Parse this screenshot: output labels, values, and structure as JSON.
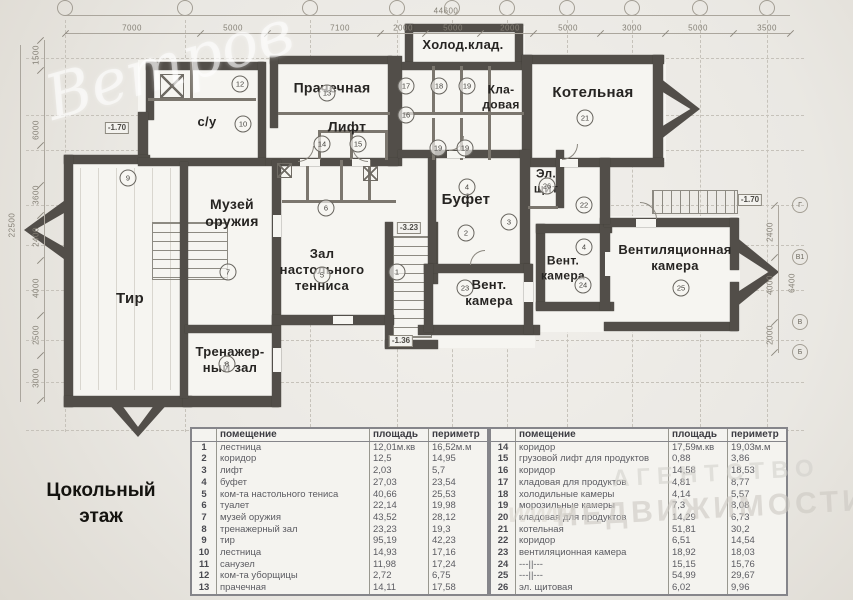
{
  "title": "Цокольный этаж",
  "watermark": {
    "script": "Ветров",
    "line1": "АГЕНТСТВО",
    "line2": "НЕДВИЖИМОСТИ",
    "url": "www"
  },
  "dims": {
    "top_total": {
      "t": "44600",
      "x": 446
    },
    "top": [
      {
        "t": "7000",
        "x": 132
      },
      {
        "t": "5000",
        "x": 233
      },
      {
        "t": "7100",
        "x": 340
      },
      {
        "t": "2000",
        "x": 403
      },
      {
        "t": "5000",
        "x": 453
      },
      {
        "t": "2000",
        "x": 510
      },
      {
        "t": "5000",
        "x": 568
      },
      {
        "t": "3000",
        "x": 632
      },
      {
        "t": "5000",
        "x": 698
      },
      {
        "t": "3500",
        "x": 767
      }
    ],
    "left_total": {
      "t": "22500",
      "y": 225
    },
    "left": [
      {
        "t": "1500",
        "y": 55
      },
      {
        "t": "6000",
        "y": 130
      },
      {
        "t": "3600",
        "y": 195
      },
      {
        "t": "2400",
        "y": 237
      },
      {
        "t": "4000",
        "y": 288
      },
      {
        "t": "2500",
        "y": 335
      },
      {
        "t": "3000",
        "y": 378
      }
    ],
    "right_total": {
      "t": "6400",
      "y": 283
    },
    "right": [
      {
        "t": "2400",
        "y": 232
      },
      {
        "t": "4000",
        "y": 285
      },
      {
        "t": "2000",
        "y": 335
      }
    ]
  },
  "axes": {
    "top_x": [
      65,
      185,
      310,
      397,
      452,
      507,
      567,
      632,
      700,
      767
    ],
    "right": [
      {
        "t": "Г",
        "y": 205
      },
      {
        "t": "В1",
        "y": 257
      },
      {
        "t": "В",
        "y": 322
      },
      {
        "t": "Б",
        "y": 352
      }
    ]
  },
  "plan": {
    "rooms": [
      {
        "label": "с/у",
        "x": 207,
        "y": 122,
        "fs": 13
      },
      {
        "label": "Прачечная",
        "x": 332,
        "y": 88,
        "fs": 14
      },
      {
        "label": "Лифт",
        "x": 347,
        "y": 127,
        "fs": 14
      },
      {
        "label": "Холод.клад.",
        "x": 463,
        "y": 45,
        "fs": 13
      },
      {
        "label": "Кла-\nдовая",
        "x": 501,
        "y": 97,
        "fs": 12
      },
      {
        "label": "Котельная",
        "x": 593,
        "y": 93,
        "fs": 15
      },
      {
        "label": "Музей\nоружия",
        "x": 232,
        "y": 213,
        "fs": 14
      },
      {
        "label": "Буфет",
        "x": 466,
        "y": 200,
        "fs": 15
      },
      {
        "label": "Эл.\nщит",
        "x": 546,
        "y": 181,
        "fs": 12
      },
      {
        "label": "Зал\nнастольного\nтенниса",
        "x": 322,
        "y": 270,
        "fs": 13
      },
      {
        "label": "Вент.\nкамера",
        "x": 489,
        "y": 293,
        "fs": 13
      },
      {
        "label": "Вент.\nкамера",
        "x": 563,
        "y": 268,
        "fs": 12
      },
      {
        "label": "Вентиляционная\nкамера",
        "x": 675,
        "y": 258,
        "fs": 13
      },
      {
        "label": "Тир",
        "x": 130,
        "y": 299,
        "fs": 15
      },
      {
        "label": "Тренажер-\nный зал",
        "x": 230,
        "y": 360,
        "fs": 13
      }
    ],
    "circles": [
      {
        "n": "12",
        "x": 240,
        "y": 84
      },
      {
        "n": "10",
        "x": 243,
        "y": 124
      },
      {
        "n": "13",
        "x": 327,
        "y": 93
      },
      {
        "n": "14",
        "x": 322,
        "y": 144
      },
      {
        "n": "15",
        "x": 358,
        "y": 144
      },
      {
        "n": "16",
        "x": 406,
        "y": 115
      },
      {
        "n": "17",
        "x": 406,
        "y": 86
      },
      {
        "n": "18",
        "x": 439,
        "y": 86
      },
      {
        "n": "19",
        "x": 467,
        "y": 86
      },
      {
        "n": "19",
        "x": 438,
        "y": 148
      },
      {
        "n": "19",
        "x": 465,
        "y": 148
      },
      {
        "n": "21",
        "x": 585,
        "y": 118
      },
      {
        "n": "6",
        "x": 326,
        "y": 208
      },
      {
        "n": "7",
        "x": 228,
        "y": 272
      },
      {
        "n": "5",
        "x": 322,
        "y": 275
      },
      {
        "n": "1",
        "x": 397,
        "y": 272
      },
      {
        "n": "4",
        "x": 467,
        "y": 187
      },
      {
        "n": "2",
        "x": 466,
        "y": 233
      },
      {
        "n": "3",
        "x": 509,
        "y": 222
      },
      {
        "n": "26",
        "x": 547,
        "y": 186
      },
      {
        "n": "22",
        "x": 584,
        "y": 205
      },
      {
        "n": "4",
        "x": 584,
        "y": 247
      },
      {
        "n": "23",
        "x": 465,
        "y": 288
      },
      {
        "n": "24",
        "x": 583,
        "y": 285
      },
      {
        "n": "25",
        "x": 681,
        "y": 288
      },
      {
        "n": "8",
        "x": 227,
        "y": 364
      },
      {
        "n": "9",
        "x": 128,
        "y": 178
      }
    ],
    "levels": [
      {
        "t": "-1.70",
        "x": 117,
        "y": 128
      },
      {
        "t": "-3.23",
        "x": 409,
        "y": 228
      },
      {
        "t": "-1.36",
        "x": 401,
        "y": 341
      },
      {
        "t": "-1.70",
        "x": 750,
        "y": 200
      }
    ]
  },
  "table": {
    "headers": [
      "помещение",
      "площадь",
      "периметр"
    ],
    "left_rows": [
      [
        "1",
        "лестница",
        "12,01м.кв",
        "16,52м.м"
      ],
      [
        "2",
        "коридор",
        "12,5",
        "14,95"
      ],
      [
        "3",
        "лифт",
        "2,03",
        "5,7"
      ],
      [
        "4",
        "буфет",
        "27,03",
        "23,54"
      ],
      [
        "5",
        "ком-та настольного тениса",
        "40,66",
        "25,53"
      ],
      [
        "6",
        "туалет",
        "22,14",
        "19,98"
      ],
      [
        "7",
        "музей оружия",
        "43,52",
        "28,12"
      ],
      [
        "8",
        "тренажерный зал",
        "23,23",
        "19,3"
      ],
      [
        "9",
        "тир",
        "95,19",
        "42,23"
      ],
      [
        "10",
        "лестница",
        "14,93",
        "17,16"
      ],
      [
        "11",
        "санузел",
        "11,98",
        "17,24"
      ],
      [
        "12",
        "ком-та уборщицы",
        "2,72",
        "6,75"
      ],
      [
        "13",
        "прачечная",
        "14,11",
        "17,58"
      ]
    ],
    "right_rows": [
      [
        "14",
        "коридор",
        "17,59м.кв",
        "19,03м.м"
      ],
      [
        "15",
        "грузовой лифт для продуктов",
        "0,88",
        "3,86"
      ],
      [
        "16",
        "коридор",
        "14,58",
        "18,53"
      ],
      [
        "17",
        "кладовая для продуктов",
        "4,81",
        "8,77"
      ],
      [
        "18",
        "холодильные камеры",
        "4,14",
        "5,57"
      ],
      [
        "19",
        "морозильные камеры",
        "7,3",
        "8,08"
      ],
      [
        "20",
        "кладовая для продуктов",
        "14,29",
        "6,73"
      ],
      [
        "21",
        "котельная",
        "51,81",
        "30,2"
      ],
      [
        "22",
        "коридор",
        "6,51",
        "14,54"
      ],
      [
        "23",
        "вентиляционная камера",
        "18,92",
        "18,03"
      ],
      [
        "24",
        "---||---",
        "15,15",
        "15,76"
      ],
      [
        "25",
        "---||---",
        "54,99",
        "29,67"
      ],
      [
        "26",
        "эл. щитовая",
        "6,02",
        "9,96"
      ]
    ]
  }
}
